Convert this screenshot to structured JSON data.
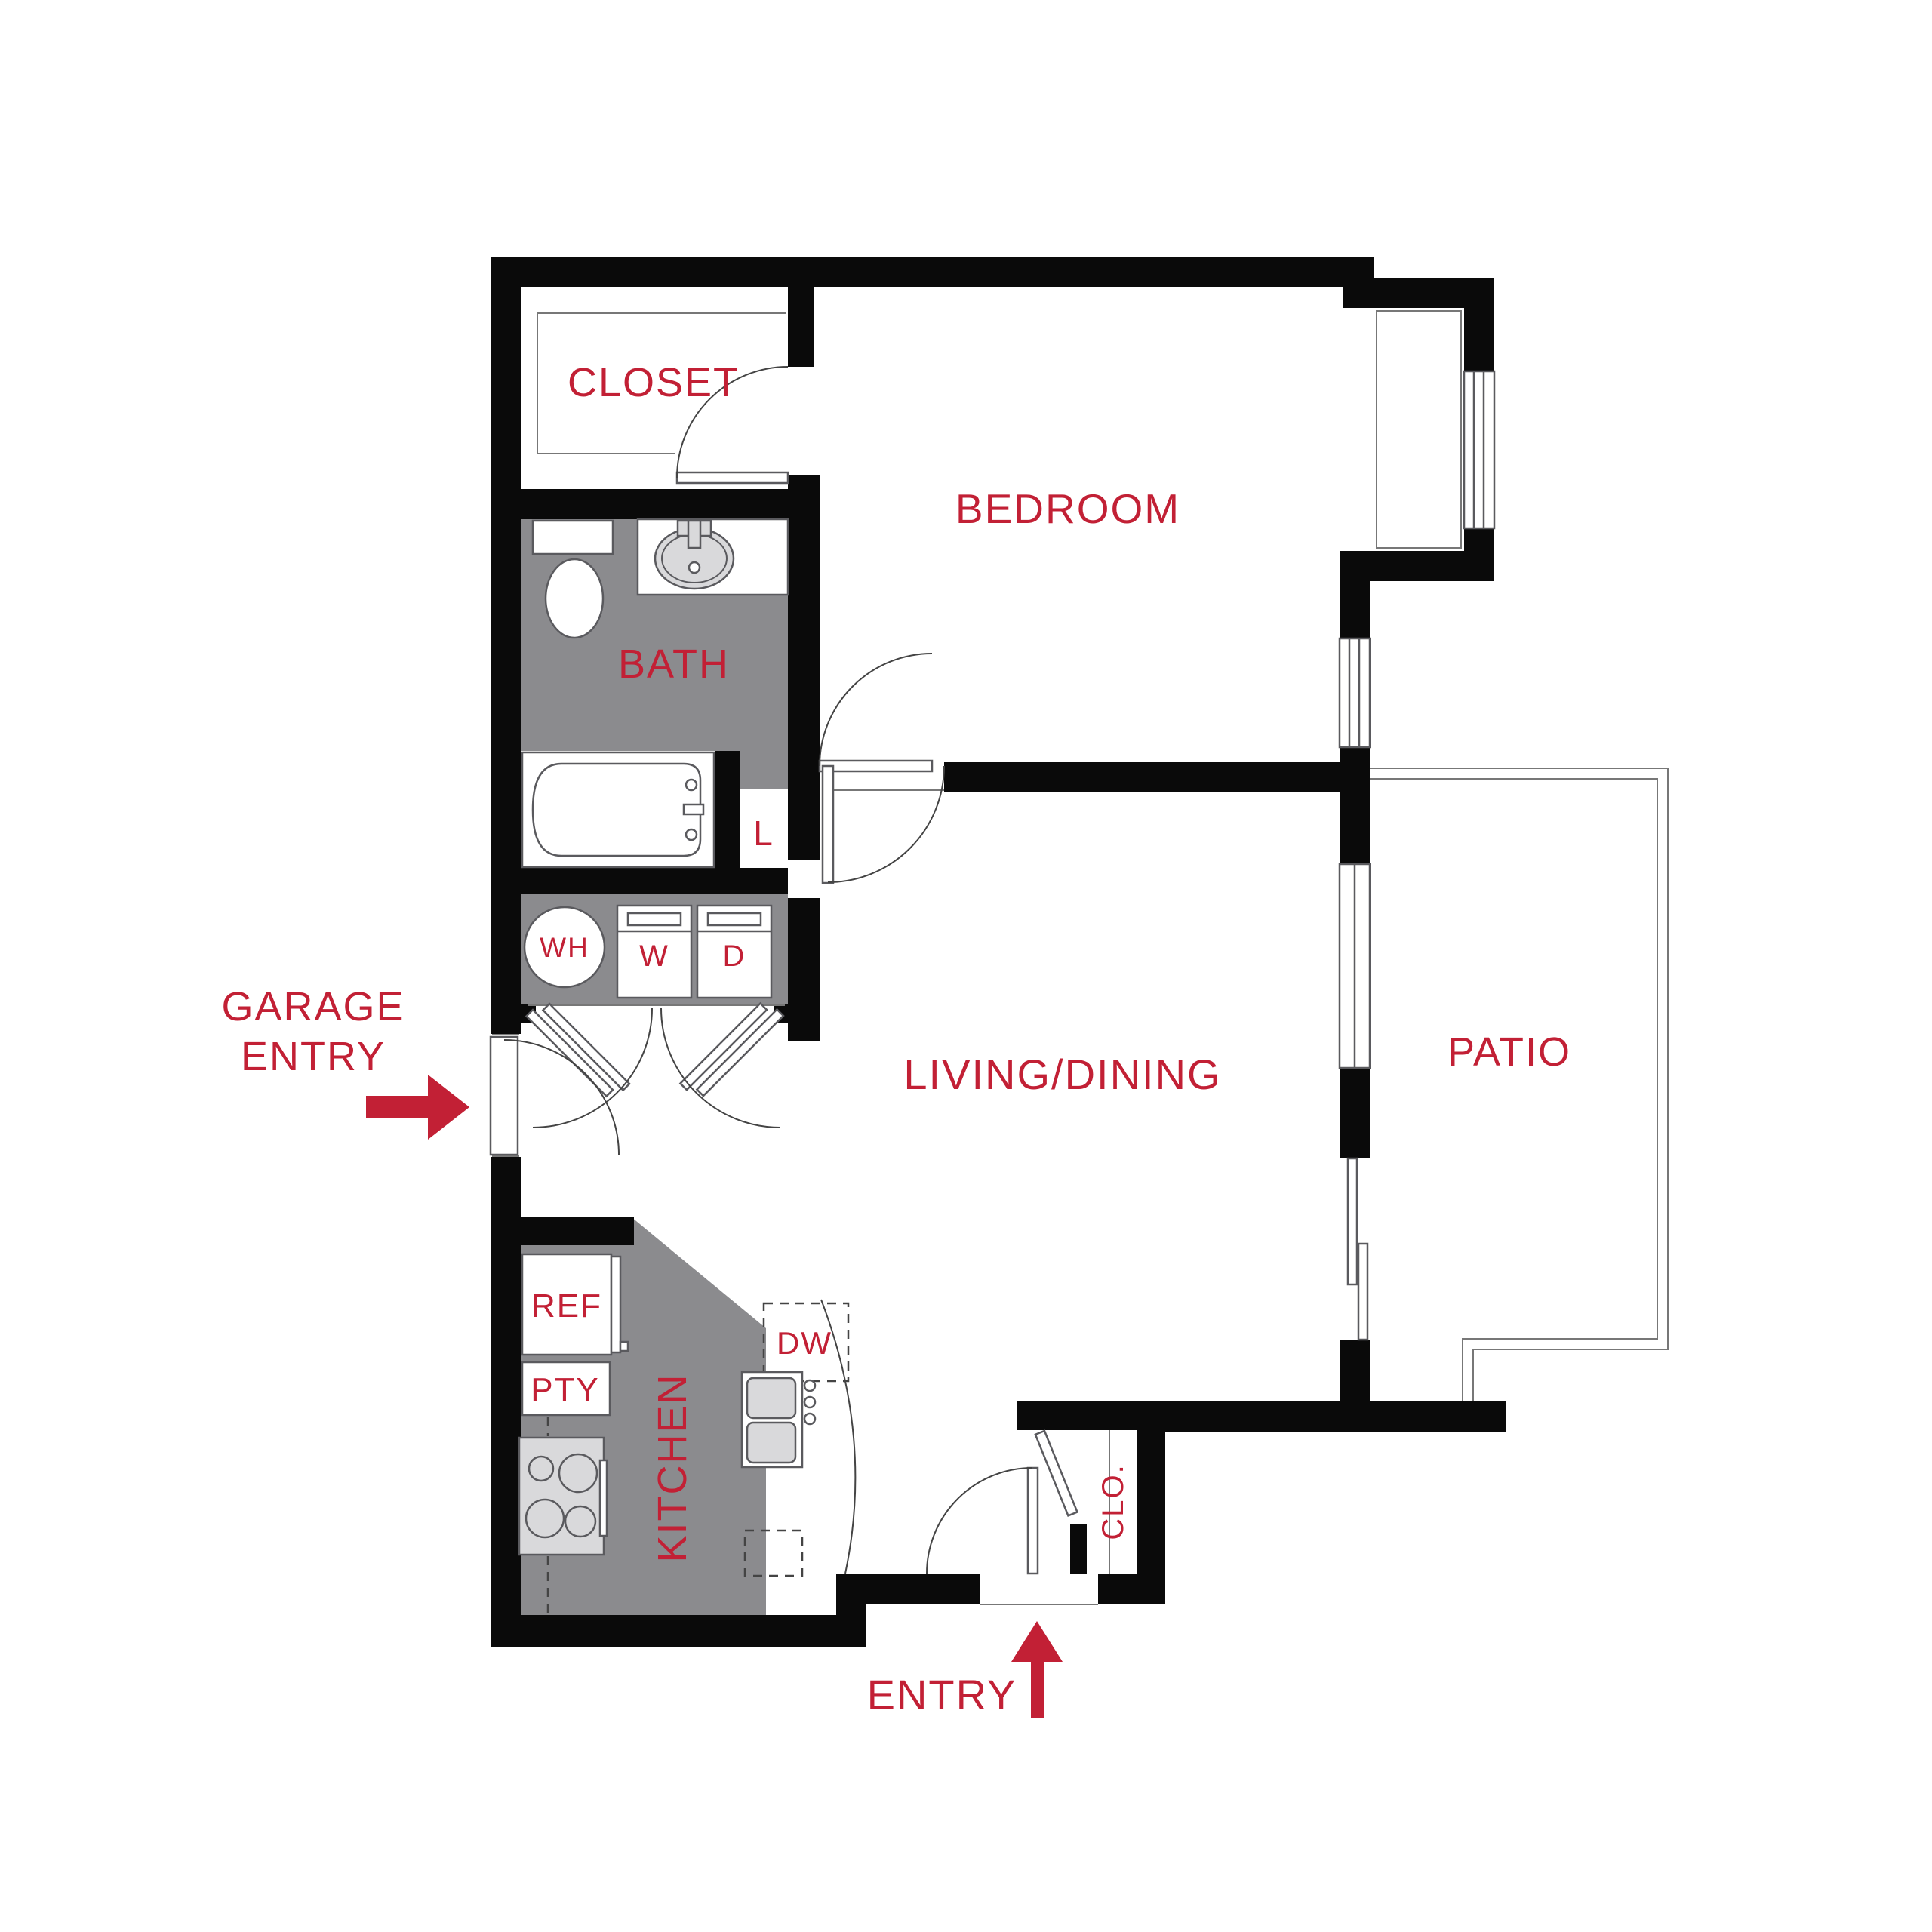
{
  "floor_plan": {
    "rooms": {
      "closet": "CLOSET",
      "bedroom": "BEDROOM",
      "bath": "BATH",
      "linen": "L",
      "living_dining": "LIVING/DINING",
      "patio": "PATIO",
      "kitchen": "KITCHEN",
      "entry_closet": "CLO."
    },
    "appliances": {
      "water_heater": "WH",
      "washer": "W",
      "dryer": "D",
      "refrigerator": "REF",
      "pantry": "PTY",
      "dishwasher": "DW"
    },
    "annotations": {
      "garage_entry_line1": "GARAGE",
      "garage_entry_line2": "ENTRY",
      "entry": "ENTRY"
    },
    "icons": {
      "garage_arrow": "right-arrow-icon",
      "entry_arrow": "up-arrow-icon"
    },
    "colors": {
      "wall": "#0a0a0a",
      "floor_gray": "#8b8b8e",
      "accent_red": "#c22035",
      "detail_line": "#5a5a5e",
      "fixture_gray": "#d9d9db",
      "background": "#ffffff"
    }
  }
}
